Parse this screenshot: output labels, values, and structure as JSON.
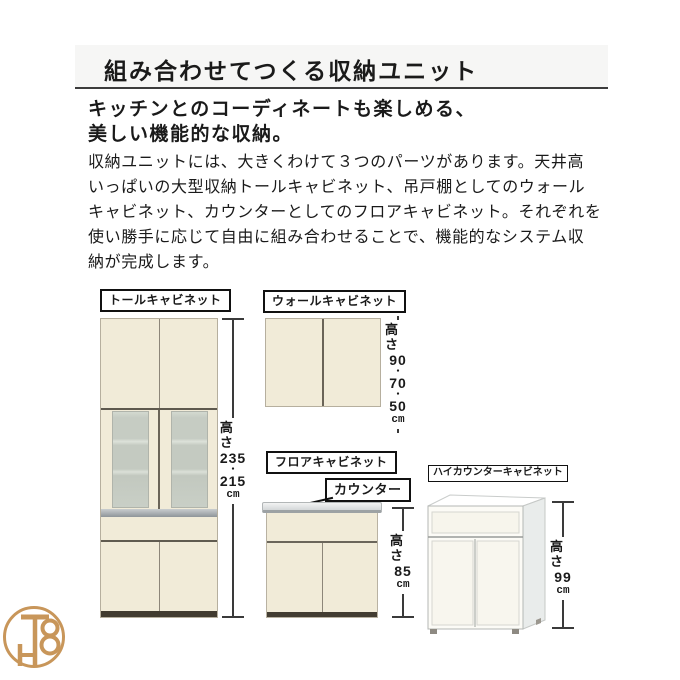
{
  "page": {
    "title": "組み合わせてつくる収納ユニット",
    "subtitle": [
      "キッチンとのコーディネートも楽しめる、",
      "美しい機能的な収納。"
    ],
    "body": [
      "収納ユニットには、大きくわけて３つのパーツがあります。天井高",
      "いっぱいの大型収納トールキャビネット、吊戸棚としてのウォール",
      "キャビネット、カウンターとしてのフロアキャビネット。それぞれを",
      "使い勝手に応じて自由に組み合わせることで、機能的なシステム収",
      "納が完成します。"
    ]
  },
  "cabinets": {
    "tall": {
      "label": "トールキャビネット",
      "measure": {
        "prefix": "高さ",
        "values": [
          "235",
          "215"
        ],
        "separator": "・",
        "unit": "cm"
      }
    },
    "wall": {
      "label": "ウォールキャビネット",
      "measure": {
        "prefix": "高さ",
        "values": [
          "90",
          "70",
          "50"
        ],
        "separator": "・",
        "unit": "cm"
      }
    },
    "floor": {
      "label": "フロアキャビネット",
      "counter_label": "カウンター",
      "measure": {
        "prefix": "高さ",
        "values": [
          "85"
        ],
        "unit": "cm"
      }
    },
    "high_counter": {
      "label": "ハイカウンターキャビネット",
      "measure": {
        "prefix": "高さ",
        "values": [
          "99"
        ],
        "unit": "cm"
      }
    }
  },
  "watermark": {
    "monogram": "TH8"
  },
  "colors": {
    "cabinet_cream": "#f1ebd8",
    "glass_panel": "#c6ccc3",
    "metal_band": "#9ba1a4",
    "base_dark": "#413b30",
    "counter_gray": "#d4d7d8",
    "label_border": "#111111",
    "rule_line": "#3c3c3c",
    "watermark_gold": "#c8965a"
  }
}
